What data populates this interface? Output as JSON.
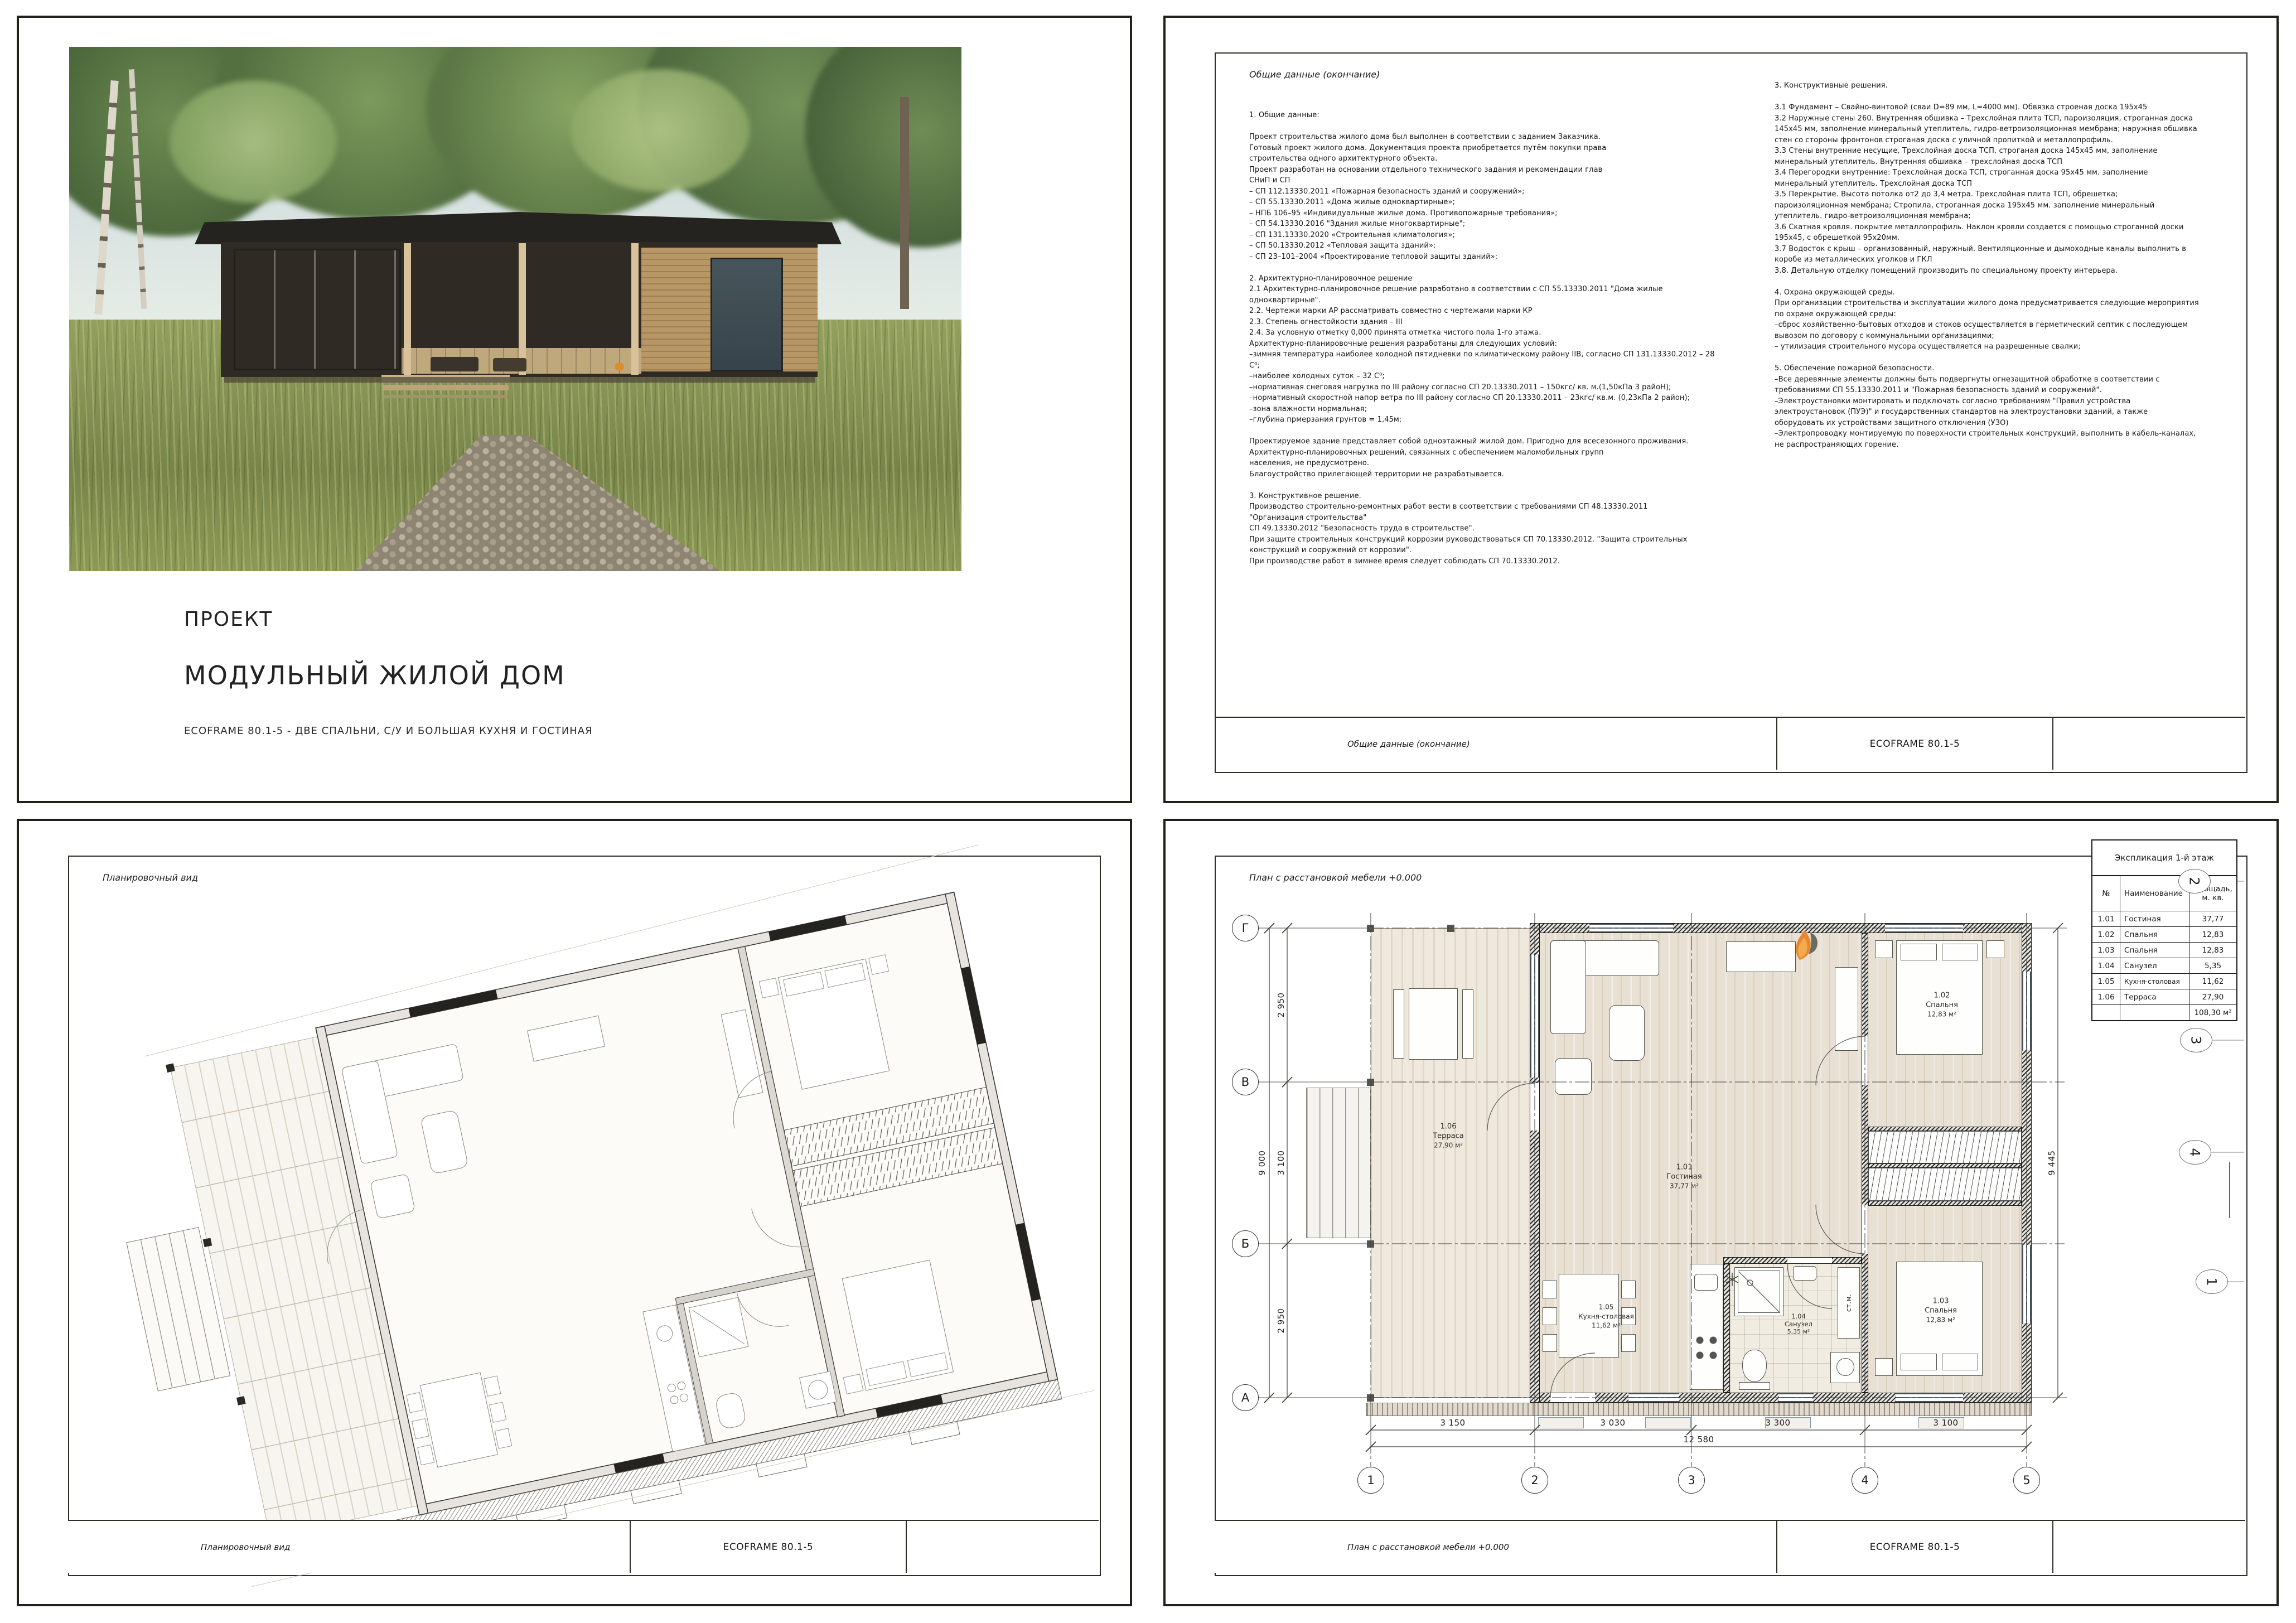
{
  "code": "ECOFRAME 80.1-5",
  "cover": {
    "kicker": "ПРОЕКТ",
    "title": "МОДУЛЬНЫЙ ЖИЛОЙ ДОМ",
    "subtitle": "ECOFRAME 80.1-5 - ДВЕ СПАЛЬНИ, С/У И БОЛЬШАЯ КУХНЯ И ГОСТИНАЯ"
  },
  "general": {
    "header": "Общие данные (окончание)",
    "footer_title": "Общие данные (окончание)",
    "col1": "1. Общие данные:\n\nПроект строительства жилого дома был выполнен в соответствии с заданием Заказчика.\nГотовый проект жилого дома. Документация проекта приобретается путём покупки права\nстроительства одного архитектурного объекта.\nПроект разработан на основании отдельного технического задания и рекомендации глав\nСНиП и СП\n– СП 112.13330.2011 «Пожарная безопасность зданий и сооружений»;\n– СП 55.13330.2011 «Дома жилые одноквартирные»;\n– НПБ 106–95 «Индивидуальные жилые дома. Противопожарные требования»;\n– СП 54.13330.2016 \"Здания жилые многоквартирные\";\n– СП 131.13330.2020 «Строительная климатология»;\n– СП 50.13330.2012 «Тепловая защита зданий»;\n– СП 23–101–2004 «Проектирование тепловой защиты зданий»;\n\n2. Архитектурно-планировочное решение\n2.1 Архитектурно-планировочное решение разработано в соответствии с СП 55.13330.2011 \"Дома жилые\nодноквартирные\".\n2.2. Чертежи марки АР рассматривать совместно с чертежами марки КР\n2.3. Степень огнестойкости здания – III\n2.4. За условную отметку 0,000 принята отметка чистого пола 1-го этажа.\nАрхитектурно-планировочные решения разработаны для следующих условий:\n–зимняя температура наиболее холодной пятидневки по климатическому району IIВ, согласно СП 131.13330.2012 – 28\nС⁰;\n–наиболее холодных суток – 32 С⁰;\n–нормативная снеговая нагрузка по III району согласно СП 20.13330.2011 – 150кгс/ кв. м.(1,50кПа 3 райоН);\n–нормативный скоростной напор ветра по III району согласно СП 20.13330.2011 – 23кгс/ кв.м. (0,23кПа 2 район);\n–зона влажности нормальная;\n–глубина прмерзания грунтов = 1,45м;\n\nПроектируемое здание представляет собой одноэтажный жилой дом. Пригодно для всесезонного проживания.\nАрхитектурно-планировочных решений, связанных с обеспечением маломобильных групп\nнаселения, не предусмотрено.\nБлагоустройство прилегающей территории не разрабатывается.\n\n3. Конструктивное решение.\nПроизводство строительно-ремонтных работ вести в соответствии с требованиями СП 48.13330.2011\n\"Организация строительства\"\nСП 49.13330.2012 \"Безопасность труда в строительстве\".\nПри защите строительных конструкций коррозии руководствоваться СП 70.13330.2012. \"Защита строительных\nконструкций и сооружений от коррозии\".\nПри производстве работ в зимнее время следует соблюдать СП 70.13330.2012.",
    "col2": "3. Конструктивные решения.\n\n3.1 Фундамент – Свайно-винтовой (сваи D=89 мм, L=4000 мм). Обвязка строеная доска 195х45\n3.2 Наружные стены 260. Внутренняя обшивка – Трехслойная плита ТСП, пароизоляция, строганная доска\n145х45 мм, заполнение минеральный утеплитель, гидро-ветроизоляционная мембрана; наружная обшивка\nстен со стороны фронтонов строганая доска с уличной пропиткой и металлопрофиль.\n3.3 Стены внутренние несущие, Трехслойная доска ТСП, строганая доска 145х45 мм, заполнение\nминеральный утеплитель. Внутренняя обшивка – трехслойная доска ТСП\n3.4 Перегородки внутренние: Трехслойная доска ТСП, строганная доска 95х45 мм. заполнение\nминеральный утеплитель. Трехслойная доска ТСП\n3.5 Перекрытие. Высота потолка от2 до 3,4 метра. Трехслойная плита ТСП, обрешетка;\nпароизоляционная мембрана; Стропила, строганная доска 195х45 мм. заполнение минеральный\nутеплитель. гидро-ветроизоляционная мембрана;\n3.6 Скатная кровля. покрытие металлопрофиль. Наклон кровли создается с помощью строганной доски\n195х45, с обрешеткой 95х20мм.\n3.7 Водосток с крыш – организованный, наружный. Вентиляционные и дымоходные каналы выполнить в\nкоробе из металлических уголков и ГКЛ\n3.8. Детальную отделку помещений производить по специальному проекту интерьера.\n\n4. Охрана окружающей среды.\nПри организации строительства и эксплуатации жилого дома предусматривается следующие мероприятия\nпо охране окружающей среды:\n–сброс хозяйственно-бытовых отходов и стоков осуществляется в герметический септик с последующем\nвывозом по договору с коммунальными организациями;\n– утилизация строительного мусора осуществляется на разрешенные свалки;\n\n5. Обеспечение пожарной безопасности.\n–Все деревянные элементы должны быть подвергнуты огнезащитной обработке в соответствии с\nтребованиями СП 55.13330.2011 и \"Пожарная безопасность зданий и сооружений\".\n–Электроустановки монтировать и подключать согласно требованиям \"Правил устройства\nэлектроустановок (ПУЭ)\" и государственных стандартов на электроустановки зданий, а также\nоборудовать их устройствами защитного отключения (УЗО)\n–Электропроводку монтируемую по поверхности строительных конструкций, выполнить в кабель-каналах,\nне распространяющих горение."
  },
  "axon": {
    "header": "Планировочный вид",
    "footer_title": "Планировочный вид"
  },
  "plan": {
    "header": "План с расстановкой мебели +0.000",
    "footer_title": "План с расстановкой мебели +0.000",
    "explication": {
      "title": "Экспликация 1-й этаж",
      "headers": [
        "№",
        "Наименование",
        "Площадь, м. кв."
      ],
      "rows": [
        [
          "1.01",
          "Гостиная",
          "37,77"
        ],
        [
          "1.02",
          "Спальня",
          "12,83"
        ],
        [
          "1.03",
          "Спальня",
          "12,83"
        ],
        [
          "1.04",
          "Санузел",
          "5,35"
        ],
        [
          "1.05",
          "Кухня-столовая",
          "11,62"
        ],
        [
          "1.06",
          "Терраса",
          "27,90"
        ]
      ],
      "total": "108,30 м²"
    },
    "rooms": {
      "r101": {
        "num": "1.01",
        "name": "Гостиная",
        "area": "37,77 м²"
      },
      "r102": {
        "num": "1.02",
        "name": "Спальня",
        "area": "12,83 м²"
      },
      "r103": {
        "num": "1.03",
        "name": "Спальня",
        "area": "12,83 м²"
      },
      "r104": {
        "num": "1.04",
        "name": "Санузел",
        "area": "5,35 м²"
      },
      "r105": {
        "num": "1.05",
        "name": "Кухня-столовая",
        "area": "11,62 м²"
      },
      "r106": {
        "num": "1.06",
        "name": "Терраса",
        "area": "27,90 м²"
      }
    },
    "dims": {
      "bottom": [
        "3 150",
        "3 030",
        "3 300",
        "3 100"
      ],
      "bottom_total": "12 580",
      "left": [
        "2 950",
        "3 100",
        "2 950"
      ],
      "left_total": "9 000",
      "right": "9 445"
    },
    "grid": {
      "cols": [
        "1",
        "2",
        "3",
        "4",
        "5"
      ],
      "rows": [
        "Г",
        "В",
        "Б",
        "А"
      ]
    },
    "markers": [
      "2",
      "3",
      "4",
      "1"
    ],
    "washer": "ст.м."
  },
  "icons": {
    "flame_logo": "orange-flame",
    "snowflake_marker": "asterisk-star"
  }
}
